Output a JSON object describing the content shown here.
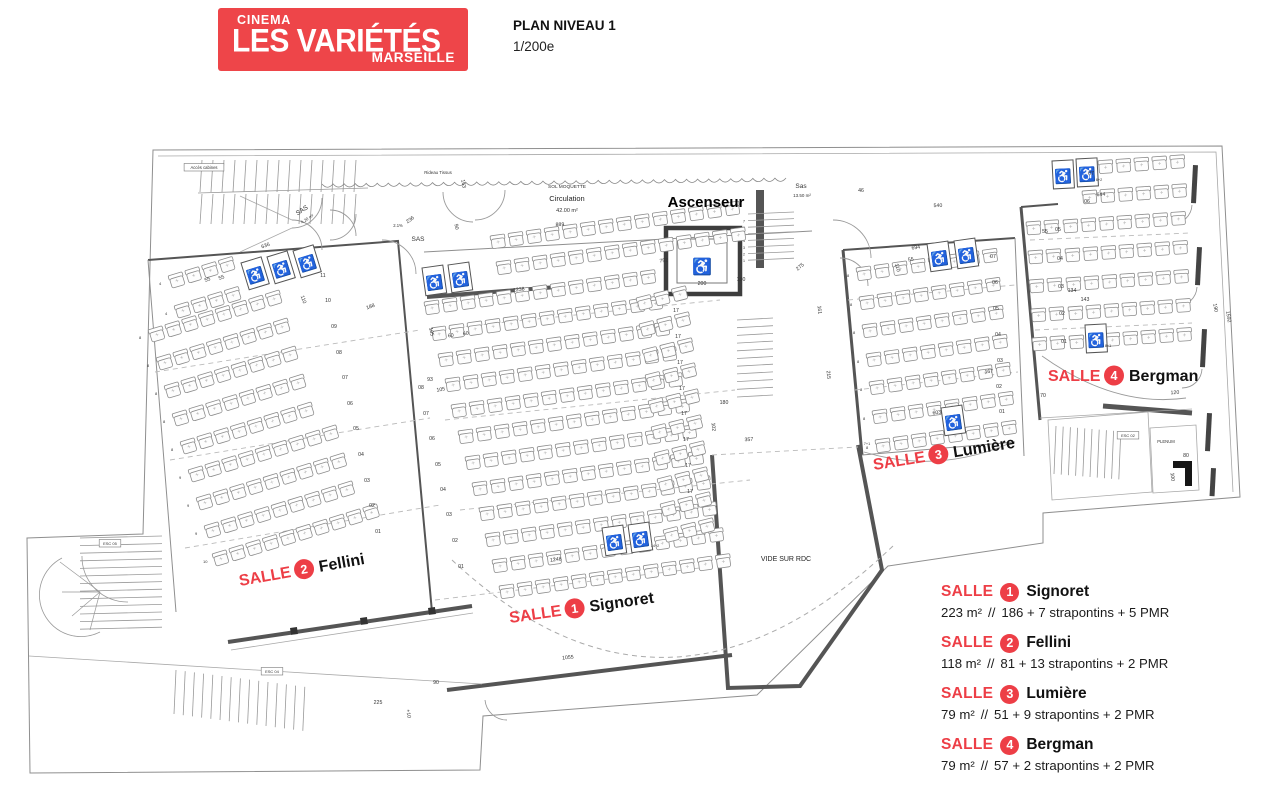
{
  "header": {
    "logo": {
      "cinema": "CINEMA",
      "name": "LES VARIÉTÉS",
      "city": "MARSEILLE",
      "bg": "#EE4549"
    },
    "plan_title": "PLAN NIVEAU 1",
    "scale": "1/200e"
  },
  "colors": {
    "red": "#ED3E46",
    "wall": "#555555",
    "line": "#8f8f8f",
    "seat": "#8c8c8c",
    "text": "#333333"
  },
  "legend": {
    "entries": [
      {
        "salle": "SALLE",
        "num": "1",
        "name": "Signoret",
        "area": "223 m²",
        "sep": "//",
        "cap": "186 + 7 strapontins + 5 PMR"
      },
      {
        "salle": "SALLE",
        "num": "2",
        "name": "Fellini",
        "area": "118 m²",
        "sep": "//",
        "cap": "81 + 13 strapontins + 2 PMR"
      },
      {
        "salle": "SALLE",
        "num": "3",
        "name": "Lumière",
        "area": "79 m²",
        "sep": "//",
        "cap": "51 + 9 strapontins + 2 PMR"
      },
      {
        "salle": "SALLE",
        "num": "4",
        "name": "Bergman",
        "area": "79 m²",
        "sep": "//",
        "cap": "57 + 2 strapontins + 2 PMR"
      }
    ]
  },
  "plan": {
    "room_labels": [
      {
        "num": "2",
        "name": "Fellini",
        "x": 240,
        "y": 586,
        "r": -10
      },
      {
        "num": "1",
        "name": "Signoret",
        "x": 510,
        "y": 623,
        "r": -8
      },
      {
        "num": "3",
        "name": "Lumière",
        "x": 874,
        "y": 470,
        "r": -9
      },
      {
        "num": "4",
        "name": "Bergman",
        "x": 1048,
        "y": 381,
        "r": 0
      }
    ],
    "area_labels": [
      {
        "t": "Ascenseur",
        "x": 706,
        "y": 207,
        "s": 15,
        "b": 1,
        "c": "#000"
      },
      {
        "t": "SOL MOQUETTE",
        "x": 567,
        "y": 188,
        "s": 4.8
      },
      {
        "t": "Circulation",
        "x": 567,
        "y": 201,
        "s": 7.5,
        "c": "#222"
      },
      {
        "t": "42.00 m²",
        "x": 567,
        "y": 212,
        "s": 5.5
      },
      {
        "t": "Sas",
        "x": 801,
        "y": 188,
        "s": 6.5
      },
      {
        "t": "13.50 m²",
        "x": 802,
        "y": 197,
        "s": 4.5
      },
      {
        "t": "SAS",
        "x": 303,
        "y": 212,
        "s": 6.5,
        "r": -33
      },
      {
        "t": "4.20 m²",
        "x": 308,
        "y": 220,
        "s": 4.2,
        "r": -33
      },
      {
        "t": "SAS",
        "x": 418,
        "y": 241,
        "s": 6.5
      },
      {
        "t": "2.1%",
        "x": 398,
        "y": 227,
        "s": 4.2
      },
      {
        "t": "VIDE SUR RDC",
        "x": 786,
        "y": 561,
        "s": 7,
        "c": "#222"
      },
      {
        "t": "Rideau Tissus",
        "x": 438,
        "y": 174,
        "s": 4.4
      },
      {
        "t": "Accès cabines",
        "x": 204,
        "y": 169,
        "s": 4.2,
        "box": 1
      },
      {
        "t": "PLENUM",
        "x": 1166,
        "y": 443,
        "s": 4.2
      },
      {
        "t": "ESC 02",
        "x": 1128,
        "y": 437,
        "s": 4,
        "box": 1
      },
      {
        "t": "ESC 05",
        "x": 110,
        "y": 545,
        "s": 4,
        "box": 1
      },
      {
        "t": "ESC 04",
        "x": 272,
        "y": 673,
        "s": 4,
        "box": 1
      }
    ],
    "dims": [
      {
        "t": "889",
        "x": 560,
        "y": 226,
        "r": -2
      },
      {
        "t": "1238",
        "x": 519,
        "y": 291,
        "r": -8
      },
      {
        "t": "752",
        "x": 664,
        "y": 262,
        "r": -8
      },
      {
        "t": "1248",
        "x": 556,
        "y": 561,
        "r": -8
      },
      {
        "t": "1055",
        "x": 568,
        "y": 659,
        "r": -6
      },
      {
        "t": "90",
        "x": 436,
        "y": 684
      },
      {
        "t": "225",
        "x": 378,
        "y": 704
      },
      {
        "t": "+10",
        "x": 407,
        "y": 714,
        "r": 80
      },
      {
        "t": "540",
        "x": 938,
        "y": 207,
        "r": -2
      },
      {
        "t": "46",
        "x": 861,
        "y": 192
      },
      {
        "t": "694",
        "x": 916,
        "y": 249,
        "r": -8
      },
      {
        "t": "55",
        "x": 911,
        "y": 261,
        "r": -8
      },
      {
        "t": "110",
        "x": 896,
        "y": 268,
        "r": 75
      },
      {
        "t": "167",
        "x": 989,
        "y": 373,
        "r": -5
      },
      {
        "t": "603",
        "x": 937,
        "y": 414,
        "r": -8
      },
      {
        "t": "215",
        "x": 827,
        "y": 375,
        "r": 85
      },
      {
        "t": "275",
        "x": 801,
        "y": 268,
        "r": -40
      },
      {
        "t": "200",
        "x": 702,
        "y": 285
      },
      {
        "t": "180",
        "x": 741,
        "y": 281
      },
      {
        "t": "161",
        "x": 818,
        "y": 310,
        "r": 85
      },
      {
        "t": "357",
        "x": 749,
        "y": 441,
        "r": -3
      },
      {
        "t": "180",
        "x": 724,
        "y": 404
      },
      {
        "t": "102",
        "x": 712,
        "y": 427,
        "r": 85
      },
      {
        "t": "644",
        "x": 1101,
        "y": 196,
        "r": -3
      },
      {
        "t": "6+2",
        "x": 1099,
        "y": 181,
        "s": 3.8
      },
      {
        "t": "8+1",
        "x": 1108,
        "y": 347,
        "s": 3.8
      },
      {
        "t": "55",
        "x": 1045,
        "y": 233
      },
      {
        "t": "134",
        "x": 1072,
        "y": 292
      },
      {
        "t": "143",
        "x": 1085,
        "y": 301
      },
      {
        "t": "120",
        "x": 1175,
        "y": 394,
        "r": -3
      },
      {
        "t": "70",
        "x": 1043,
        "y": 397
      },
      {
        "t": "80",
        "x": 1186,
        "y": 457
      },
      {
        "t": "100",
        "x": 1171,
        "y": 477,
        "r": 85
      },
      {
        "t": "190",
        "x": 1214,
        "y": 308,
        "r": 80
      },
      {
        "t": "1592",
        "x": 1227,
        "y": 317,
        "r": 80
      },
      {
        "t": "163",
        "x": 462,
        "y": 184,
        "r": 80
      },
      {
        "t": "236",
        "x": 411,
        "y": 221,
        "r": -35
      },
      {
        "t": "90",
        "x": 455,
        "y": 227,
        "r": 80
      },
      {
        "t": "188",
        "x": 371,
        "y": 308,
        "r": -20
      },
      {
        "t": "110",
        "x": 302,
        "y": 300,
        "r": 70
      },
      {
        "t": "636",
        "x": 266,
        "y": 247,
        "r": -20
      },
      {
        "t": "55",
        "x": 208,
        "y": 281,
        "r": -20
      },
      {
        "t": "55",
        "x": 222,
        "y": 279,
        "r": -20
      },
      {
        "t": "105",
        "x": 430,
        "y": 332,
        "r": 80
      },
      {
        "t": "93",
        "x": 430,
        "y": 381
      },
      {
        "t": "105",
        "x": 441,
        "y": 391,
        "r": -8
      },
      {
        "t": "60",
        "x": 451,
        "y": 337,
        "r": -8
      },
      {
        "t": "60",
        "x": 466,
        "y": 335,
        "r": -8
      },
      {
        "t": "14+2",
        "x": 655,
        "y": 547,
        "s": 3.8
      },
      {
        "t": "7+1",
        "x": 867,
        "y": 445,
        "s": 3.8
      }
    ],
    "row_labels": [
      {
        "t": "01",
        "x": 461,
        "y": 568
      },
      {
        "t": "02",
        "x": 455,
        "y": 542
      },
      {
        "t": "03",
        "x": 449,
        "y": 516
      },
      {
        "t": "04",
        "x": 443,
        "y": 491
      },
      {
        "t": "05",
        "x": 438,
        "y": 466
      },
      {
        "t": "06",
        "x": 432,
        "y": 440
      },
      {
        "t": "07",
        "x": 426,
        "y": 415
      },
      {
        "t": "08",
        "x": 421,
        "y": 389
      },
      {
        "t": "17",
        "x": 676,
        "y": 312
      },
      {
        "t": "17",
        "x": 678,
        "y": 338
      },
      {
        "t": "17",
        "x": 680,
        "y": 364
      },
      {
        "t": "17",
        "x": 682,
        "y": 390
      },
      {
        "t": "17",
        "x": 684,
        "y": 415
      },
      {
        "t": "17",
        "x": 686,
        "y": 441
      },
      {
        "t": "17",
        "x": 688,
        "y": 467
      },
      {
        "t": "17",
        "x": 690,
        "y": 493
      },
      {
        "t": "01",
        "x": 378,
        "y": 533
      },
      {
        "t": "02",
        "x": 372,
        "y": 507
      },
      {
        "t": "03",
        "x": 367,
        "y": 482
      },
      {
        "t": "04",
        "x": 361,
        "y": 456
      },
      {
        "t": "05",
        "x": 356,
        "y": 430
      },
      {
        "t": "06",
        "x": 350,
        "y": 405
      },
      {
        "t": "07",
        "x": 345,
        "y": 379
      },
      {
        "t": "08",
        "x": 339,
        "y": 354
      },
      {
        "t": "09",
        "x": 334,
        "y": 328
      },
      {
        "t": "10",
        "x": 328,
        "y": 302
      },
      {
        "t": "11",
        "x": 323,
        "y": 277
      },
      {
        "t": "01",
        "x": 1002,
        "y": 413
      },
      {
        "t": "02",
        "x": 999,
        "y": 388
      },
      {
        "t": "03",
        "x": 1000,
        "y": 362
      },
      {
        "t": "04",
        "x": 998,
        "y": 336
      },
      {
        "t": "05",
        "x": 996,
        "y": 310
      },
      {
        "t": "06",
        "x": 995,
        "y": 284
      },
      {
        "t": "07",
        "x": 993,
        "y": 258
      },
      {
        "t": "01",
        "x": 1064,
        "y": 343
      },
      {
        "t": "02",
        "x": 1062,
        "y": 315
      },
      {
        "t": "03",
        "x": 1061,
        "y": 288
      },
      {
        "t": "04",
        "x": 1060,
        "y": 260
      },
      {
        "t": "05",
        "x": 1058,
        "y": 231
      },
      {
        "t": "06",
        "x": 1087,
        "y": 203
      },
      {
        "t": "07",
        "x": 1091,
        "y": 175
      }
    ],
    "rooms": [
      {
        "id": "signoret",
        "angle": -8,
        "pitch": 18.2,
        "rows": [
          {
            "x": 490,
            "y": 236,
            "n": 14
          },
          {
            "x": 496,
            "y": 262,
            "n": 14
          },
          {
            "x": 424,
            "y": 302,
            "n": 13
          },
          {
            "x": 431,
            "y": 328,
            "n": 13
          },
          {
            "x": 438,
            "y": 354,
            "n": 13
          },
          {
            "x": 445,
            "y": 379,
            "n": 13
          },
          {
            "x": 451,
            "y": 405,
            "n": 13
          },
          {
            "x": 458,
            "y": 431,
            "n": 13
          },
          {
            "x": 465,
            "y": 457,
            "n": 13
          },
          {
            "x": 472,
            "y": 483,
            "n": 13
          },
          {
            "x": 479,
            "y": 508,
            "n": 13
          },
          {
            "x": 485,
            "y": 534,
            "n": 13
          },
          {
            "x": 492,
            "y": 560,
            "n": 13
          },
          {
            "x": 499,
            "y": 586,
            "n": 13
          }
        ]
      },
      {
        "id": "signoret-right",
        "angle": -14,
        "pitch": 18.2,
        "rows": [
          {
            "x": 636,
            "y": 298,
            "n": 3
          },
          {
            "x": 639,
            "y": 324,
            "n": 3
          },
          {
            "x": 642,
            "y": 350,
            "n": 3
          },
          {
            "x": 645,
            "y": 375,
            "n": 3
          },
          {
            "x": 648,
            "y": 401,
            "n": 3
          },
          {
            "x": 651,
            "y": 427,
            "n": 3
          },
          {
            "x": 654,
            "y": 453,
            "n": 3
          },
          {
            "x": 657,
            "y": 479,
            "n": 3
          },
          {
            "x": 660,
            "y": 504,
            "n": 3
          },
          {
            "x": 663,
            "y": 530,
            "n": 3
          }
        ]
      },
      {
        "id": "fellini",
        "angle": -17,
        "pitch": 17.5,
        "count_labels": true,
        "rows": [
          {
            "x": 168,
            "y": 276,
            "n": 4
          },
          {
            "x": 174,
            "y": 306,
            "n": 4
          },
          {
            "x": 148,
            "y": 330,
            "n": 8
          },
          {
            "x": 156,
            "y": 358,
            "n": 8
          },
          {
            "x": 164,
            "y": 386,
            "n": 8
          },
          {
            "x": 172,
            "y": 414,
            "n": 8
          },
          {
            "x": 180,
            "y": 442,
            "n": 8
          },
          {
            "x": 188,
            "y": 470,
            "n": 9
          },
          {
            "x": 196,
            "y": 498,
            "n": 9
          },
          {
            "x": 204,
            "y": 526,
            "n": 9
          },
          {
            "x": 212,
            "y": 554,
            "n": 10
          }
        ]
      },
      {
        "id": "lumiere",
        "angle": -8,
        "pitch": 18.2,
        "count_labels": true,
        "rows": [
          {
            "x": 856,
            "y": 268,
            "n": 8
          },
          {
            "x": 859,
            "y": 297,
            "n": 8
          },
          {
            "x": 862,
            "y": 325,
            "n": 8
          },
          {
            "x": 866,
            "y": 354,
            "n": 8
          },
          {
            "x": 869,
            "y": 382,
            "n": 8
          },
          {
            "x": 872,
            "y": 411,
            "n": 8
          },
          {
            "x": 875,
            "y": 440,
            "n": 8
          }
        ]
      },
      {
        "id": "bergman",
        "angle": -4,
        "pitch": 18,
        "rows": [
          {
            "x": 1080,
            "y": 162,
            "n": 6
          },
          {
            "x": 1082,
            "y": 191,
            "n": 6
          },
          {
            "x": 1063,
            "y": 220,
            "n": 7
          },
          {
            "x": 1065,
            "y": 249,
            "n": 7
          },
          {
            "x": 1066,
            "y": 278,
            "n": 7
          },
          {
            "x": 1068,
            "y": 307,
            "n": 7
          },
          {
            "x": 1069,
            "y": 336,
            "n": 7
          }
        ]
      },
      {
        "id": "bergman-left",
        "angle": -4,
        "pitch": 18,
        "rows": [
          {
            "x": 1026,
            "y": 222,
            "n": 2
          },
          {
            "x": 1028,
            "y": 251,
            "n": 2
          },
          {
            "x": 1029,
            "y": 280,
            "n": 2
          },
          {
            "x": 1031,
            "y": 309,
            "n": 2
          },
          {
            "x": 1032,
            "y": 338,
            "n": 2
          }
        ]
      }
    ],
    "wheelchairs": [
      {
        "x": 241,
        "y": 263,
        "r": -17
      },
      {
        "x": 267,
        "y": 257,
        "r": -17
      },
      {
        "x": 293,
        "y": 251,
        "r": -17
      },
      {
        "x": 422,
        "y": 268,
        "r": -8
      },
      {
        "x": 448,
        "y": 265,
        "r": -8
      },
      {
        "x": 602,
        "y": 528,
        "r": -8
      },
      {
        "x": 628,
        "y": 525,
        "r": -8
      },
      {
        "x": 927,
        "y": 244,
        "r": -8
      },
      {
        "x": 954,
        "y": 241,
        "r": -8
      },
      {
        "x": 941,
        "y": 408,
        "r": -8
      },
      {
        "x": 1052,
        "y": 161,
        "r": -3
      },
      {
        "x": 1076,
        "y": 159,
        "r": -3
      },
      {
        "x": 1085,
        "y": 325,
        "r": -3
      }
    ],
    "stair_numbers": [
      "1",
      "2",
      "3",
      "4",
      "5",
      "6",
      "7"
    ]
  }
}
